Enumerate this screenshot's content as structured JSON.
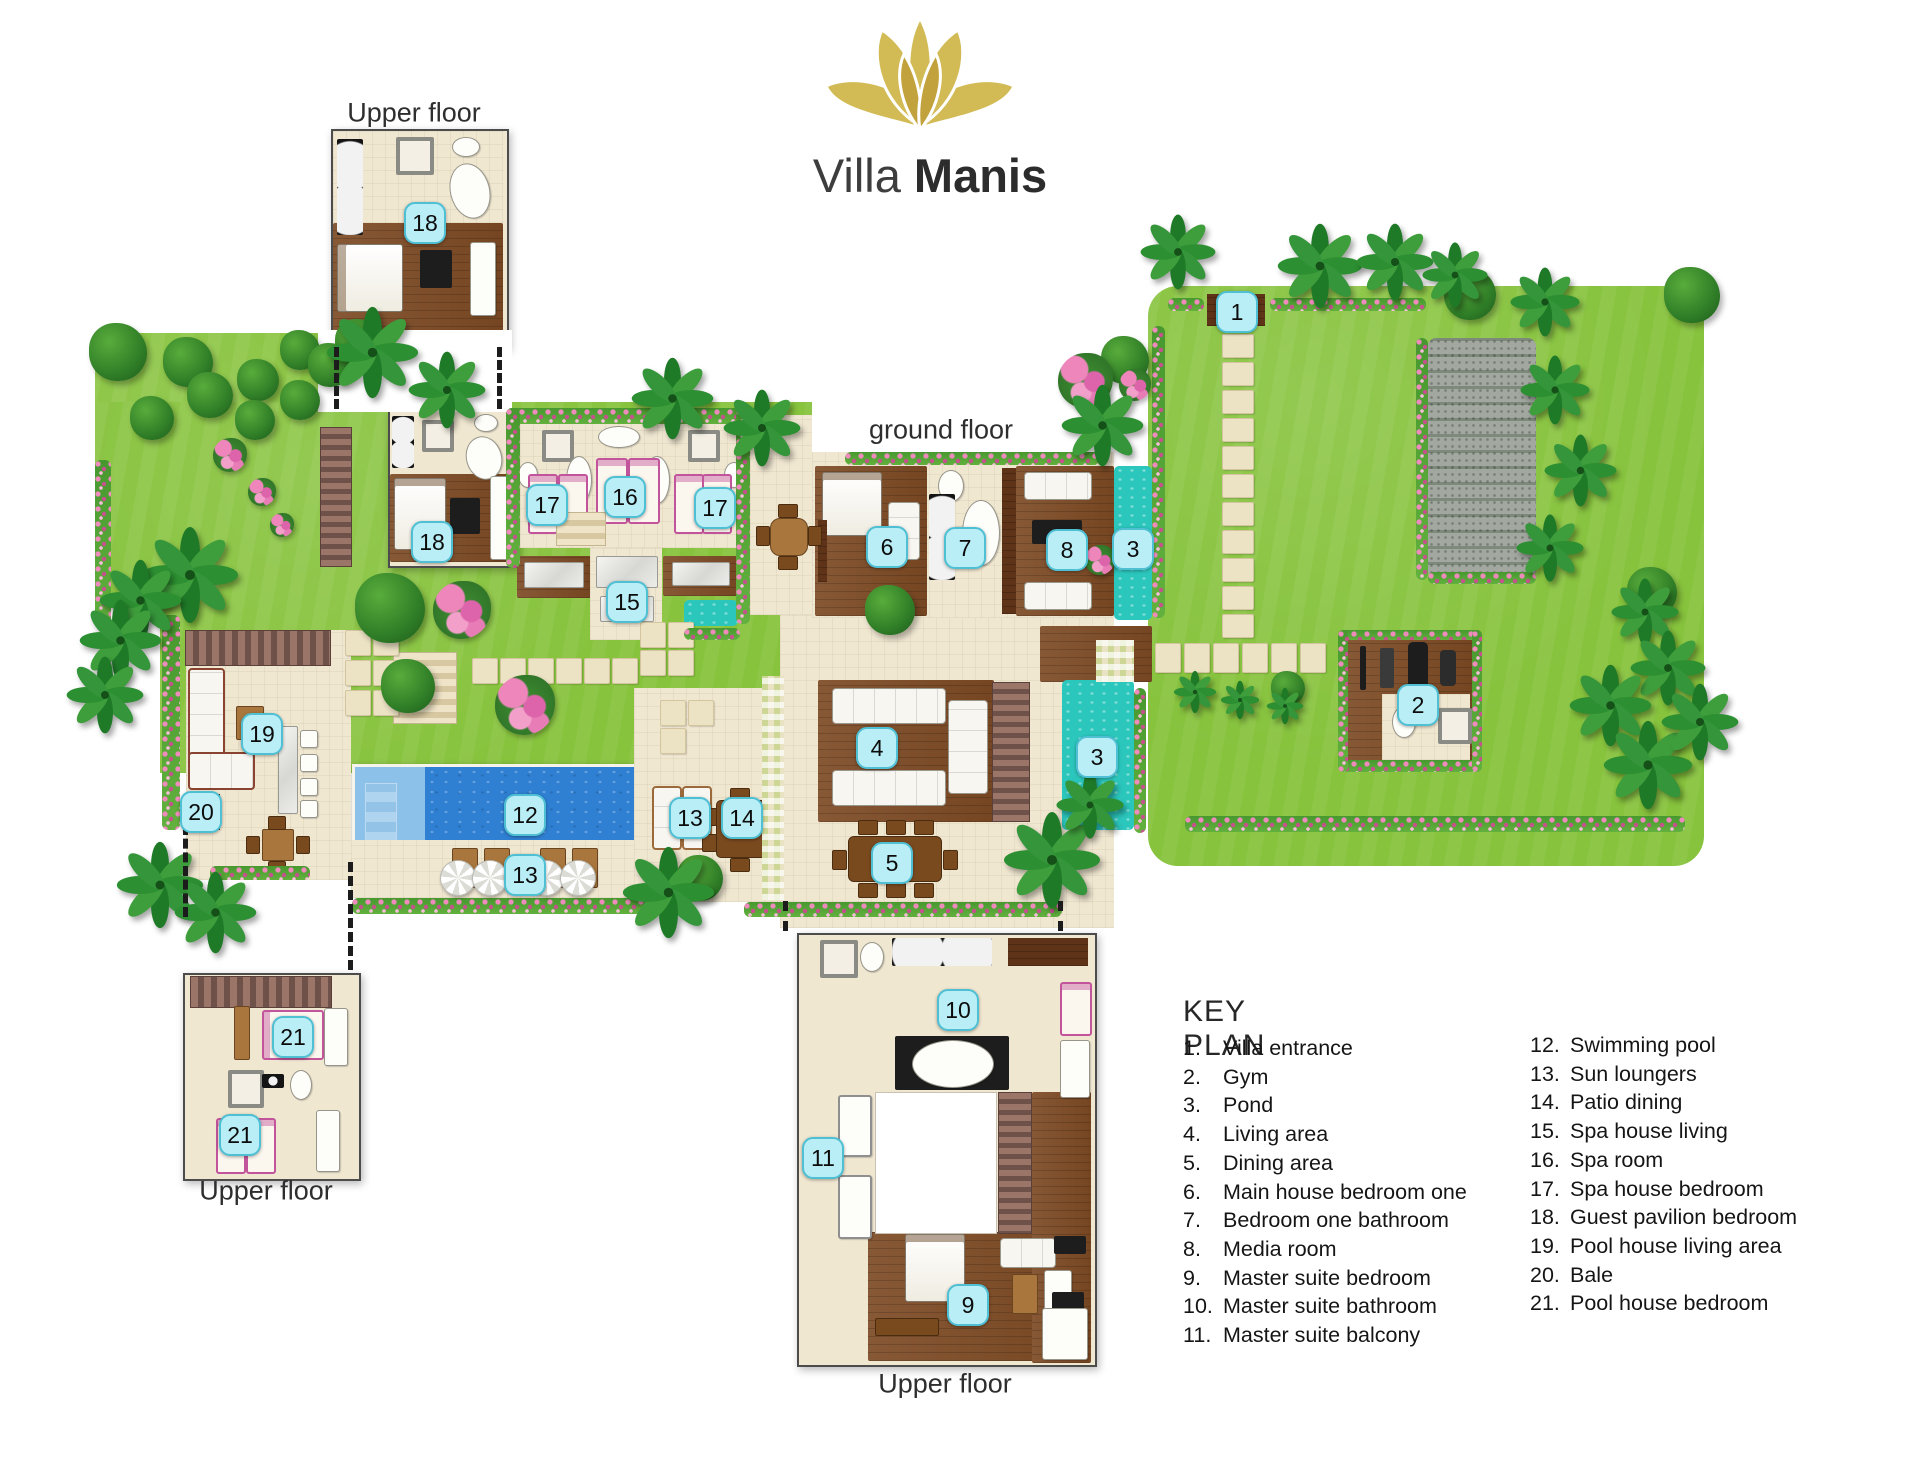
{
  "brand": {
    "title_light": "Villa",
    "title_bold": "Manis",
    "logo": "lotus-icon"
  },
  "floor_labels": [
    {
      "text": "Upper floor",
      "x": 414,
      "y": 113
    },
    {
      "text": "ground floor",
      "x": 941,
      "y": 430
    },
    {
      "text": "Upper floor",
      "x": 266,
      "y": 1191
    },
    {
      "text": "Upper floor",
      "x": 945,
      "y": 1384
    }
  ],
  "markers": [
    {
      "n": "1",
      "x": 1237,
      "y": 312
    },
    {
      "n": "2",
      "x": 1418,
      "y": 705
    },
    {
      "n": "3",
      "x": 1133,
      "y": 549
    },
    {
      "n": "3",
      "x": 1097,
      "y": 757
    },
    {
      "n": "4",
      "x": 877,
      "y": 748
    },
    {
      "n": "5",
      "x": 892,
      "y": 863
    },
    {
      "n": "6",
      "x": 887,
      "y": 547
    },
    {
      "n": "7",
      "x": 965,
      "y": 548
    },
    {
      "n": "8",
      "x": 1067,
      "y": 550
    },
    {
      "n": "9",
      "x": 968,
      "y": 1305
    },
    {
      "n": "10",
      "x": 958,
      "y": 1010
    },
    {
      "n": "11",
      "x": 823,
      "y": 1158
    },
    {
      "n": "12",
      "x": 525,
      "y": 815
    },
    {
      "n": "13",
      "x": 525,
      "y": 875
    },
    {
      "n": "13",
      "x": 690,
      "y": 818
    },
    {
      "n": "14",
      "x": 742,
      "y": 818
    },
    {
      "n": "15",
      "x": 627,
      "y": 602
    },
    {
      "n": "16",
      "x": 625,
      "y": 497
    },
    {
      "n": "17",
      "x": 547,
      "y": 505
    },
    {
      "n": "17",
      "x": 715,
      "y": 508
    },
    {
      "n": "18",
      "x": 425,
      "y": 223
    },
    {
      "n": "18",
      "x": 432,
      "y": 542
    },
    {
      "n": "19",
      "x": 262,
      "y": 734
    },
    {
      "n": "20",
      "x": 201,
      "y": 812
    },
    {
      "n": "21",
      "x": 293,
      "y": 1037
    },
    {
      "n": "21",
      "x": 240,
      "y": 1135
    }
  ],
  "legend": {
    "title": "KEY PLAN",
    "col1": [
      {
        "num": "1.",
        "label": "Villa entrance"
      },
      {
        "num": "2.",
        "label": "Gym"
      },
      {
        "num": "3.",
        "label": "Pond"
      },
      {
        "num": "4.",
        "label": "Living area"
      },
      {
        "num": "5.",
        "label": "Dining area"
      },
      {
        "num": "6.",
        "label": "Main house bedroom one"
      },
      {
        "num": "7.",
        "label": "Bedroom one bathroom"
      },
      {
        "num": "8.",
        "label": "Media room"
      },
      {
        "num": "9.",
        "label": "Master suite bedroom"
      },
      {
        "num": "10.",
        "label": "Master suite bathroom"
      },
      {
        "num": "11.",
        "label": "Master suite balcony"
      }
    ],
    "col2": [
      {
        "num": "12.",
        "label": "Swimming pool"
      },
      {
        "num": "13.",
        "label": "Sun loungers"
      },
      {
        "num": "14.",
        "label": "Patio dining"
      },
      {
        "num": "15.",
        "label": "Spa house living"
      },
      {
        "num": "16.",
        "label": "Spa room"
      },
      {
        "num": "17.",
        "label": "Spa house bedroom"
      },
      {
        "num": "18.",
        "label": "Guest pavilion bedroom"
      },
      {
        "num": "19.",
        "label": "Pool house living area"
      },
      {
        "num": "20.",
        "label": "Bale"
      },
      {
        "num": "21.",
        "label": "Pool house bedroom"
      }
    ]
  },
  "colors": {
    "logo_gold": "#d2ba55",
    "logo_gold_dark": "#c2a23c",
    "marker_fill": "#b9eef6",
    "marker_border": "#4fc0d4",
    "lawn_green": "#87c33d",
    "pool_blue": "#2f80d3",
    "pond_teal": "#2bc7bd",
    "deck_brown": "#7d4a24",
    "terrace_cream": "#f0e7d1"
  }
}
